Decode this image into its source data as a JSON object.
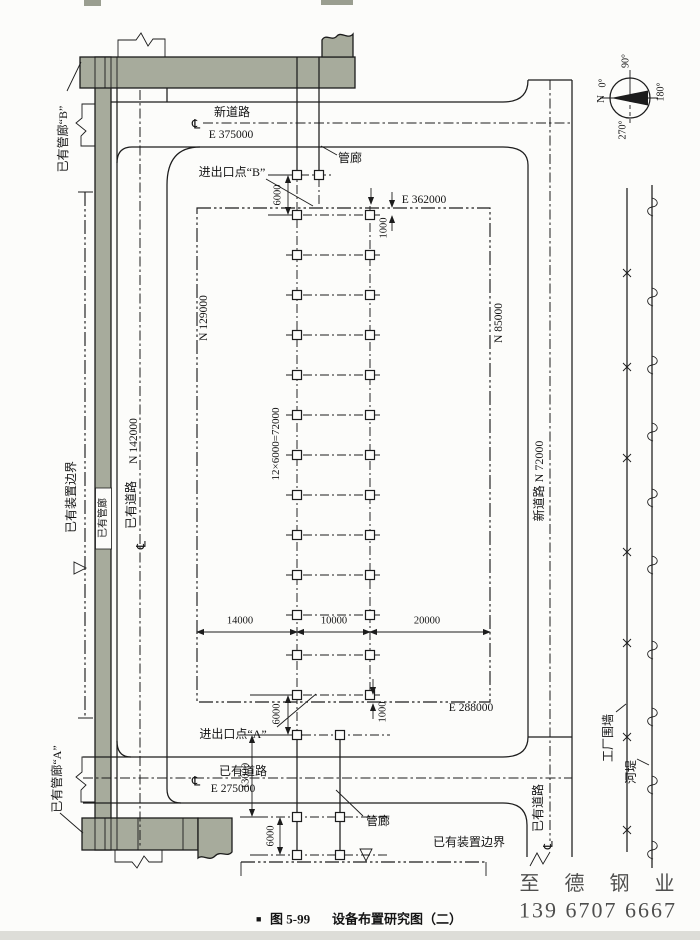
{
  "caption": {
    "bullet": "■",
    "fig": "图 5-99",
    "title": "设备布置研究图（二）"
  },
  "compass": {
    "n": "N",
    "d0": "0°",
    "d90": "90°",
    "d180": "180°",
    "d270": "270°"
  },
  "roads": {
    "top_name": "新道路",
    "top_coord": "E 375000",
    "left_name": "已有道路",
    "left_grid": "N 142000",
    "right_name": "新道路 N 72000",
    "bottom_name": "已有道路",
    "bottom_coord": "E 275000",
    "se_name": "已有道路",
    "centerline_symbol": "℄"
  },
  "boundaries": {
    "left_label": "已有装置边界",
    "bottom_label": "已有装置边界",
    "plot_n_left": "N 129000",
    "plot_n_right": "N 85000",
    "plot_e_top": "E 362000",
    "plot_e_bottom": "E 288000",
    "factory_wall": "工厂围墙",
    "river": "河堤"
  },
  "corridors": {
    "existing_b": "已有管廊“B”",
    "existing_a": "已有管廊“A”",
    "existing_strip": "已有管廊",
    "rack_top": "管廊",
    "rack_bottom": "管廊"
  },
  "points": {
    "entry_b": "进出口点“B”",
    "entry_a": "进出口点“A”"
  },
  "dims": {
    "top_6000": "6000",
    "top_1000": "1000",
    "bay": "12×6000=72000",
    "w14000": "14000",
    "w10000": "10000",
    "w20000": "20000",
    "bot_6000_a": "6000",
    "bot_13000": "13000",
    "bot_6000_b": "6000",
    "bot_1000": "1000"
  },
  "watermark": {
    "line1": "至 德 钢 业",
    "line2": "139 6707 6667",
    "color": "#a9b4df"
  },
  "colors": {
    "corridor_fill": "#a7ab9c",
    "line": "#1c1c1c",
    "paper": "#fcfcfa"
  }
}
